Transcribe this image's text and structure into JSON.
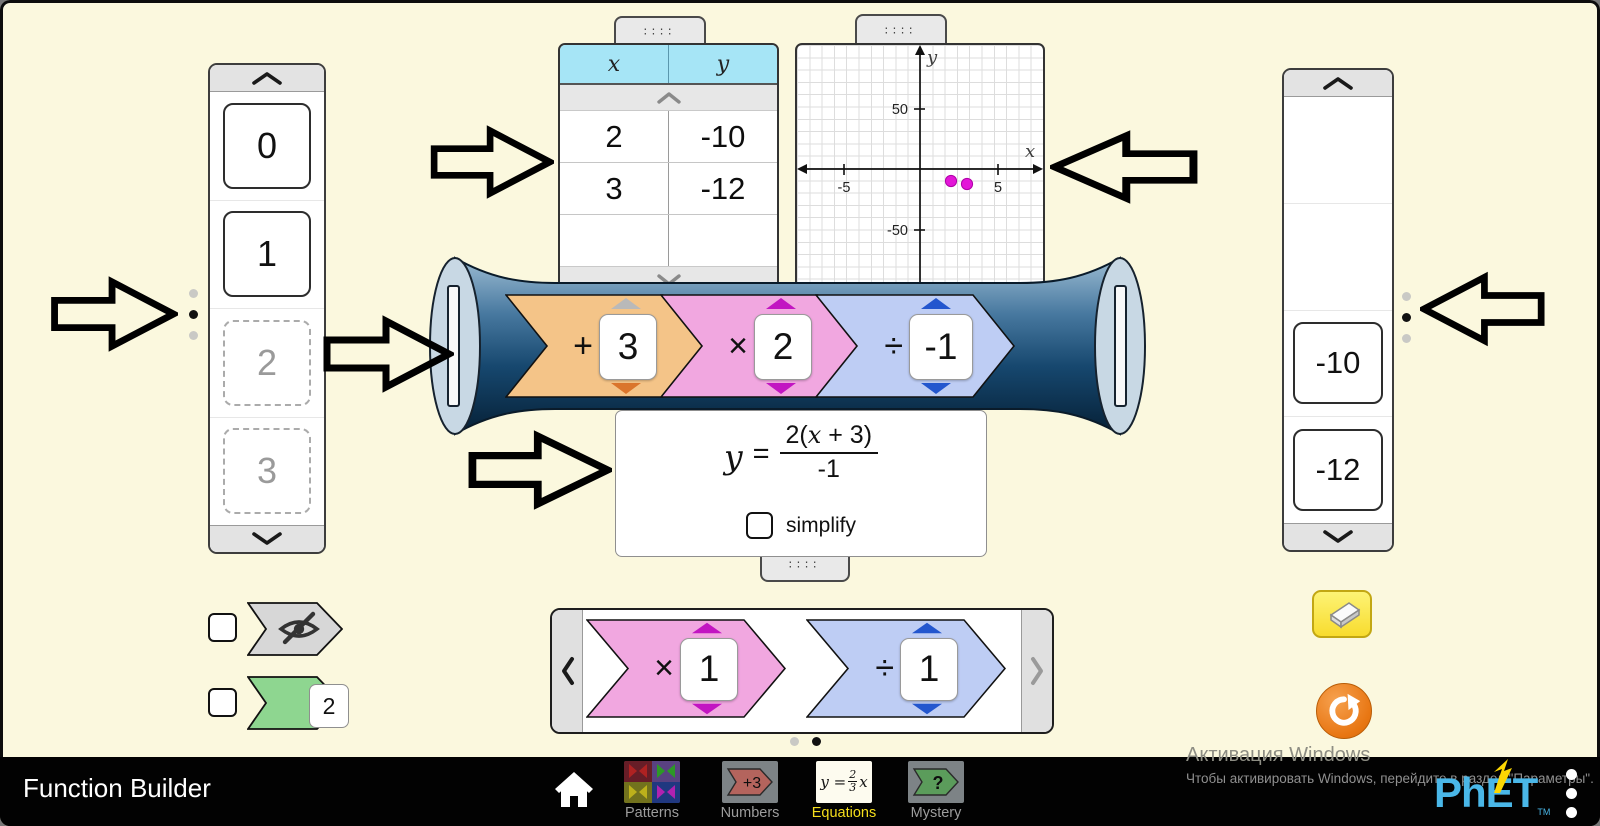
{
  "app": {
    "title": "Function Builder",
    "screen": "Equations"
  },
  "input_carousel": {
    "cards": [
      {
        "value": "0",
        "placed": false
      },
      {
        "value": "1",
        "placed": false
      },
      {
        "value": "2",
        "placed": true
      },
      {
        "value": "3",
        "placed": true
      }
    ],
    "page_dots": {
      "count": 3,
      "active_index": 1
    }
  },
  "table": {
    "headers": {
      "x": "x",
      "y": "y"
    },
    "rows": [
      [
        "2",
        "-10"
      ],
      [
        "3",
        "-12"
      ],
      [
        "",
        ""
      ]
    ]
  },
  "graph": {
    "xlabel": "x",
    "ylabel": "y",
    "x_ticks": [
      "-5",
      "5"
    ],
    "y_ticks": [
      "50",
      "-50"
    ],
    "points": [
      {
        "x": 2,
        "y": -10
      },
      {
        "x": 3,
        "y": -12
      }
    ],
    "point_color": "#E316D8"
  },
  "output_carousel": {
    "cards": [
      "-10",
      "-12"
    ],
    "page_dots": {
      "count": 3,
      "active_index": 1
    }
  },
  "builder": {
    "functions": [
      {
        "operator": "+",
        "value": "3",
        "color": "#F4C488"
      },
      {
        "operator": "×",
        "value": "2",
        "color": "#F1A7E0"
      },
      {
        "operator": "÷",
        "value": "-1",
        "color": "#BECDF4"
      }
    ]
  },
  "equation": {
    "lhs": "y",
    "equals": "=",
    "numerator_pre": "2(",
    "numerator_var": "x",
    "numerator_post": " + 3)",
    "denominator": "-1",
    "simplify_label": "simplify",
    "simplify_checked": false
  },
  "function_carousel": {
    "cards": [
      {
        "operator": "×",
        "value": "1",
        "color": "#F1A7E0"
      },
      {
        "operator": "÷",
        "value": "1",
        "color": "#BECDF4"
      }
    ],
    "page_dots": {
      "count": 2,
      "active_index": 1
    }
  },
  "view_options": {
    "hide_functions": {
      "checked": false,
      "icon": "eye-slash-icon"
    },
    "see_inside": {
      "checked": false,
      "card_value": "2"
    }
  },
  "controls": {
    "eraser_icon": "eraser-icon",
    "reset_icon": "reset-icon"
  },
  "navbar": {
    "title": "Function Builder",
    "home_icon": "home-icon",
    "screens": [
      {
        "label": "Patterns",
        "selected": false
      },
      {
        "label": "Numbers",
        "selected": false,
        "icon_text": "+3"
      },
      {
        "label": "Equations",
        "selected": true,
        "icon_y": "y",
        "icon_eq": "=",
        "icon_num": "2",
        "icon_den": "3",
        "icon_var": "x"
      },
      {
        "label": "Mystery",
        "selected": false,
        "icon_text": "?"
      }
    ],
    "logo_text": "PhET",
    "logo_tm": "TM",
    "menu_icon": "kebab-menu-icon"
  },
  "watermark": {
    "line1": "Активация Windows",
    "line2": "Чтобы активировать Windows, перейдите в раздел \"Параметры\"."
  },
  "colors": {
    "background": "#FBF8DE",
    "table_header_cyan": "#A6E5F6",
    "card_orange": "#F4C488",
    "card_pink": "#F1A7E0",
    "card_blue": "#BECDF4",
    "card_green": "#8ED690",
    "point_magenta": "#E316D8",
    "eraser_yellow": "#FCE94F",
    "reset_orange": "#EE8422",
    "selected_tab_yellow": "#F5DE1C",
    "phet_blue": "#4AB7E8"
  }
}
